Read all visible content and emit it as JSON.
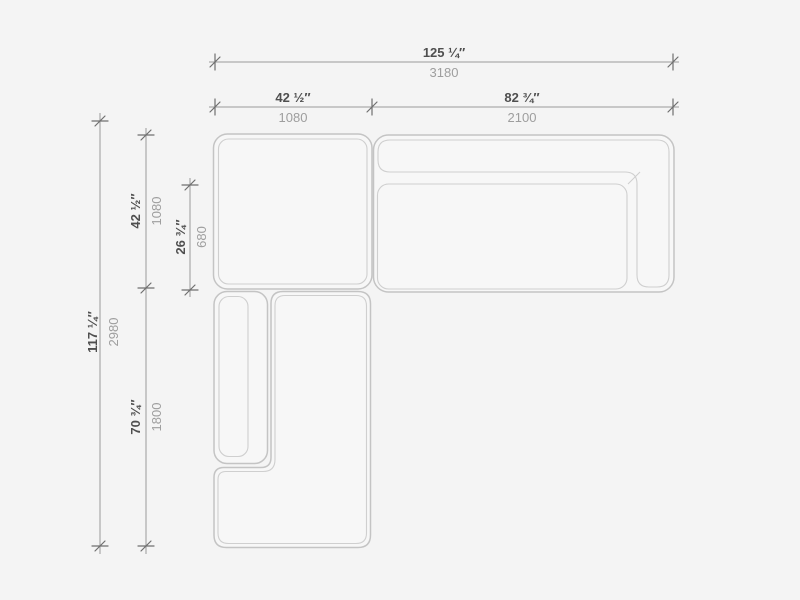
{
  "page": {
    "background": "#f4f4f4",
    "drawing_type": "sectional-sofa-top-view-dimension-drawing"
  },
  "palette": {
    "background": "#f4f4f4",
    "furniture_fill": "#f7f7f7",
    "furniture_outline": "#c4c4c4",
    "cushion_outline": "#cfcfcf",
    "dimension_line": "#9a9a9a",
    "tick": "#6f6f6f",
    "inch_text": "#4f4f4f",
    "mm_text": "#9e9e9e"
  },
  "dimensions": {
    "horizontal": [
      {
        "name": "overall-width",
        "inches": "125 ¼″",
        "mm": "3180"
      },
      {
        "name": "corner-module-width",
        "inches": "42 ½″",
        "mm": "1080"
      },
      {
        "name": "sofa-width",
        "inches": "82 ¾″",
        "mm": "2100"
      }
    ],
    "vertical": [
      {
        "name": "overall-depth",
        "inches": "117 ¼″",
        "mm": "2980"
      },
      {
        "name": "corner-module-depth",
        "inches": "42 ½″",
        "mm": "1080"
      },
      {
        "name": "seat-depth",
        "inches": "26 ¾″",
        "mm": "680"
      },
      {
        "name": "chaise-length",
        "inches": "70 ¾″",
        "mm": "1800"
      }
    ]
  },
  "components": [
    {
      "name": "corner-module",
      "description": "square corner/ottoman module, top left"
    },
    {
      "name": "right-sofa",
      "description": "sofa with back cushion and right armrest"
    },
    {
      "name": "chaise-module",
      "description": "long chaise with left armrest, bottom left"
    }
  ]
}
